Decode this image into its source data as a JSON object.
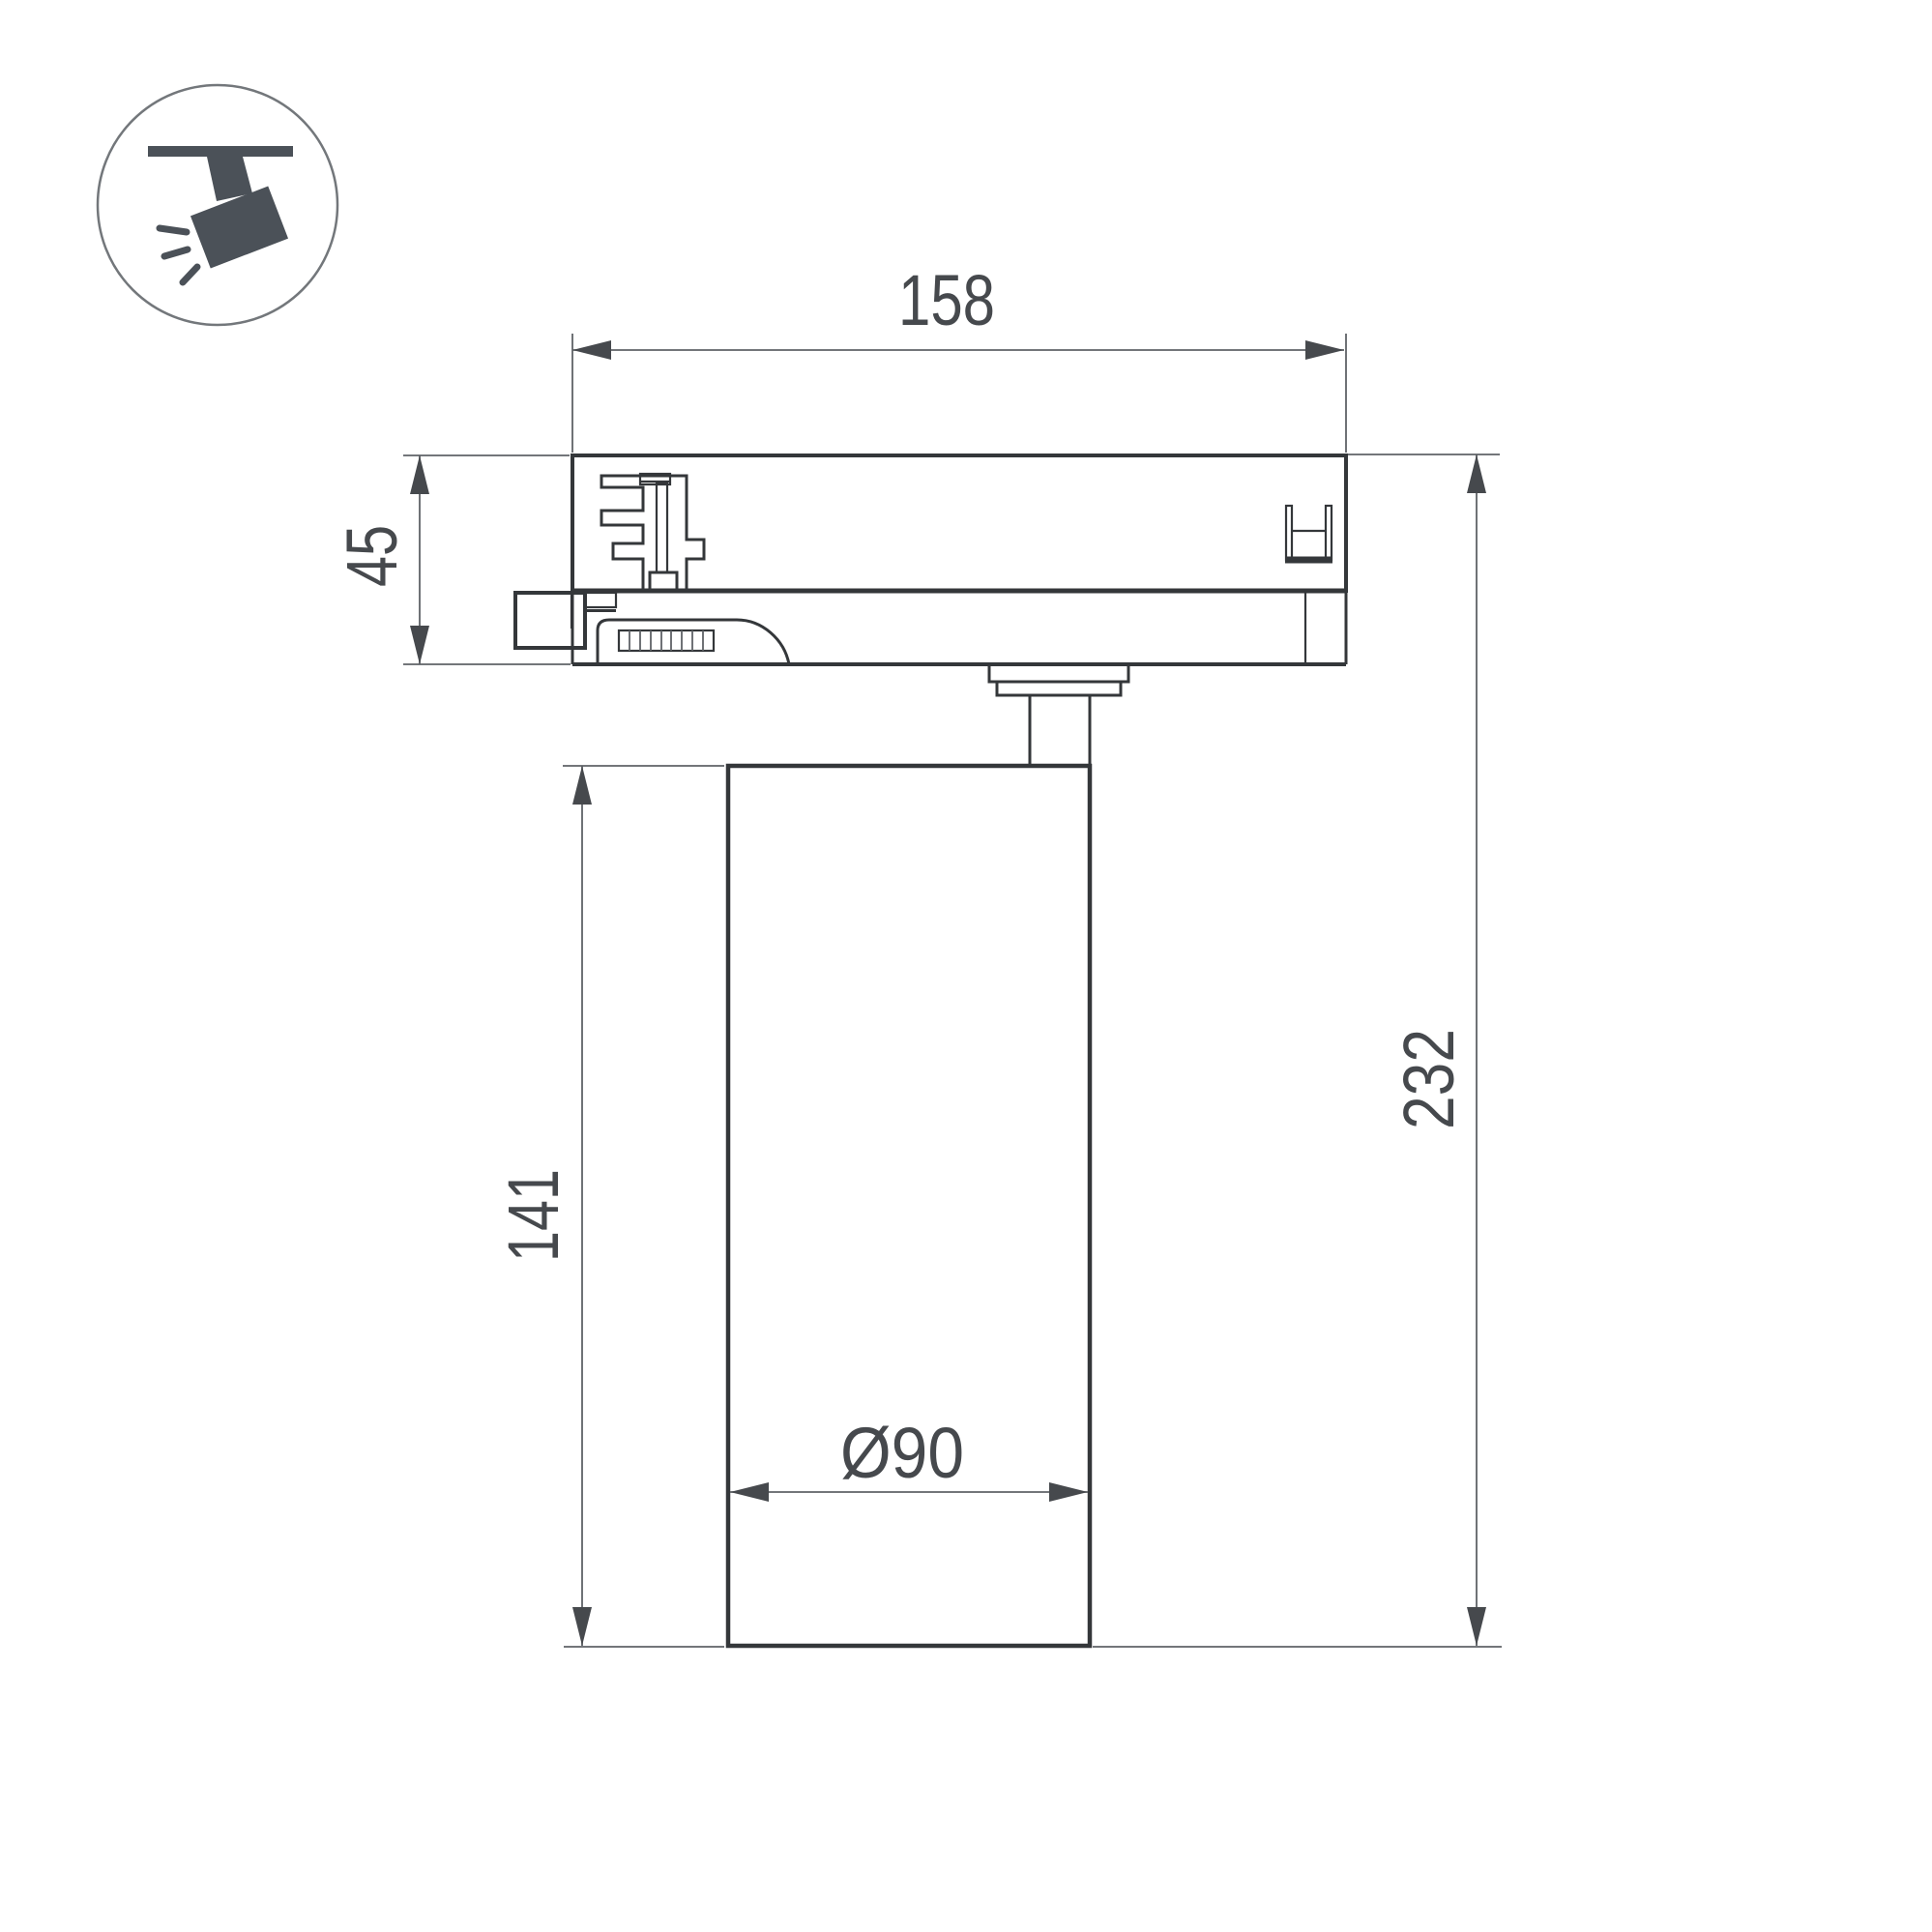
{
  "page": {
    "background": "#ffffff"
  },
  "icon": {
    "label": "ceiling-track-spotlight"
  },
  "drawing": {
    "colors": {
      "background": "#ffffff",
      "line": "#34373a",
      "dim": "#5f6367",
      "dimtext": "#46494d",
      "icon": "#4b5158",
      "circle": "#73777b"
    },
    "dimensions": {
      "adapter_width": "158",
      "adapter_height": "45",
      "body_height": "141",
      "total_height": "232",
      "body_diameter": "Ø90"
    }
  }
}
